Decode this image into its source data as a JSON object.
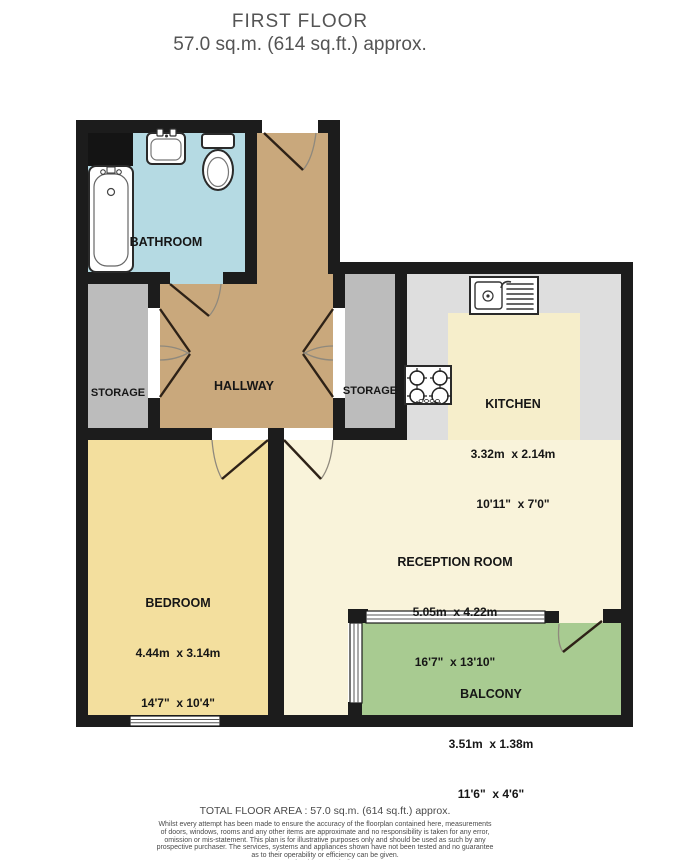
{
  "title": {
    "floor": "FIRST FLOOR",
    "area": "57.0 sq.m. (614 sq.ft.) approx."
  },
  "rooms": {
    "bathroom": {
      "label": "BATHROOM"
    },
    "hallway": {
      "label": "HALLWAY"
    },
    "storage_left": {
      "label": "STORAGE"
    },
    "storage_right": {
      "label": "STORAGE"
    },
    "kitchen": {
      "label": "KITCHEN",
      "metric": "3.32m  x 2.14m",
      "imperial": "10'11\"  x 7'0\""
    },
    "reception": {
      "label": "RECEPTION ROOM",
      "metric": "5.05m  x 4.22m",
      "imperial": "16'7\"  x 13'10\""
    },
    "bedroom": {
      "label": "BEDROOM",
      "metric": "4.44m  x 3.14m",
      "imperial": "14'7\"  x 10'4\""
    },
    "balcony": {
      "label": "BALCONY",
      "metric": "3.51m  x 1.38m",
      "imperial": "11'6\"  x 4'6\""
    }
  },
  "footer": {
    "total_area": "TOTAL FLOOR AREA : 57.0 sq.m. (614 sq.ft.) approx.",
    "disclaimer": [
      "Whilst every attempt has been made to ensure the accuracy of the floorplan contained here, measurements",
      "of doors, windows, rooms and any other items are approximate and no responsibility is taken for any error,",
      "omission or mis-statement. This plan is for illustrative purposes only and should be used as such by any",
      "prospective purchaser. The services, systems and appliances shown have not been tested and no guarantee",
      "as to their operability or efficiency can be given."
    ],
    "credit": "Made with Metropix ©2026"
  },
  "colors": {
    "wall": "#1c1c1c",
    "bathroom_floor": "#b5dae3",
    "hallway_floor": "#c9a87c",
    "storage_floor": "#bcbcbc",
    "kitchen_counter": "#dedede",
    "kitchen_floor": "#f6eecb",
    "reception_floor": "#f9f3da",
    "bedroom_floor": "#f3df9e",
    "balcony_floor": "#a8cb91",
    "title_text": "#545454",
    "label_text": "#161616"
  }
}
